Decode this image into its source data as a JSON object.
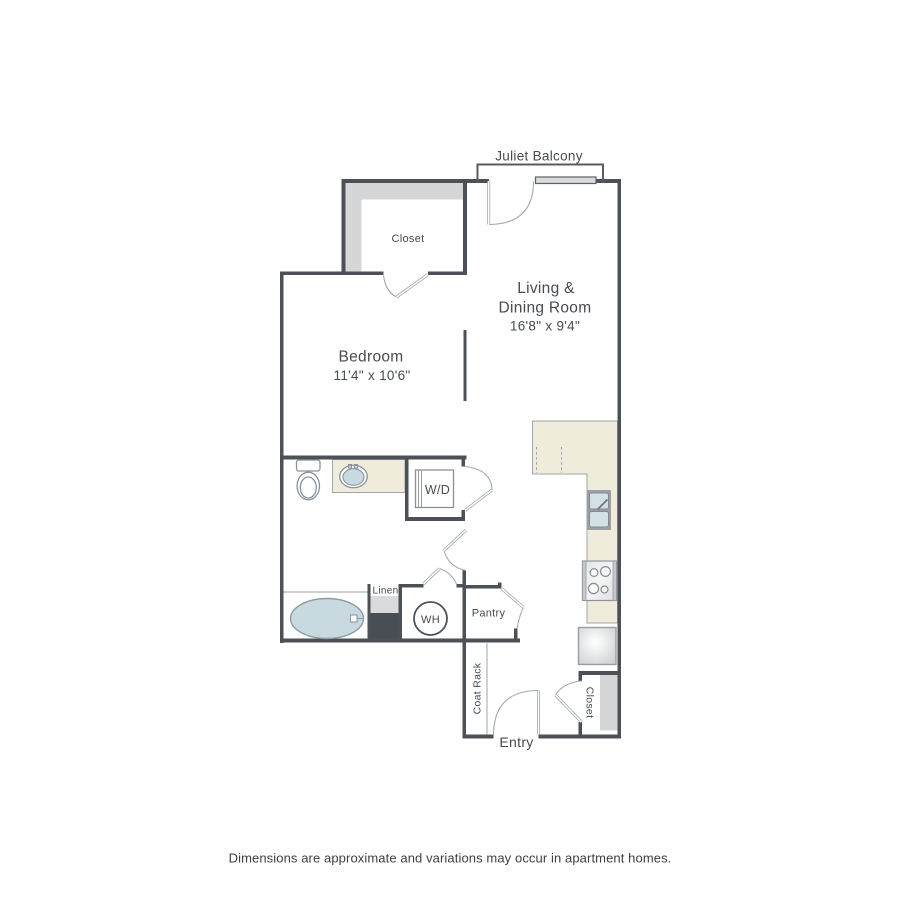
{
  "plan": {
    "balcony_label": "Juliet Balcony",
    "upper_closet_label": "Closet",
    "living_room": {
      "name_line1": "Living &",
      "name_line2": "Dining Room",
      "dims": "16'8\" x 9'4\""
    },
    "bedroom": {
      "name": "Bedroom",
      "dims": "11'4\" x 10'6\""
    },
    "washer_dryer_label": "W/D",
    "linen_label": "Linen",
    "water_heater_label": "WH",
    "pantry_label": "Pantry",
    "coat_rack_label": "Coat Rack",
    "entry_closet_label": "Closet",
    "entry_label": "Entry"
  },
  "footer": {
    "disclaimer": "Dimensions are approximate and variations may occur in apartment homes."
  },
  "colors": {
    "wall": "#4B5157",
    "wall-light": "#555C62",
    "arc": "#A3AAAF",
    "text": "#454B51",
    "gray": "#D5D6D8",
    "gray-light": "#DADBDD",
    "dark": "#474E54",
    "beige": "#F0ECDC",
    "beige-stroke": "#A0A6AA",
    "fixture": "#8A9298",
    "blue": "#C9D9E0",
    "sink-blue": "#D3E1E7",
    "footer-text": "#3E3E3E"
  }
}
